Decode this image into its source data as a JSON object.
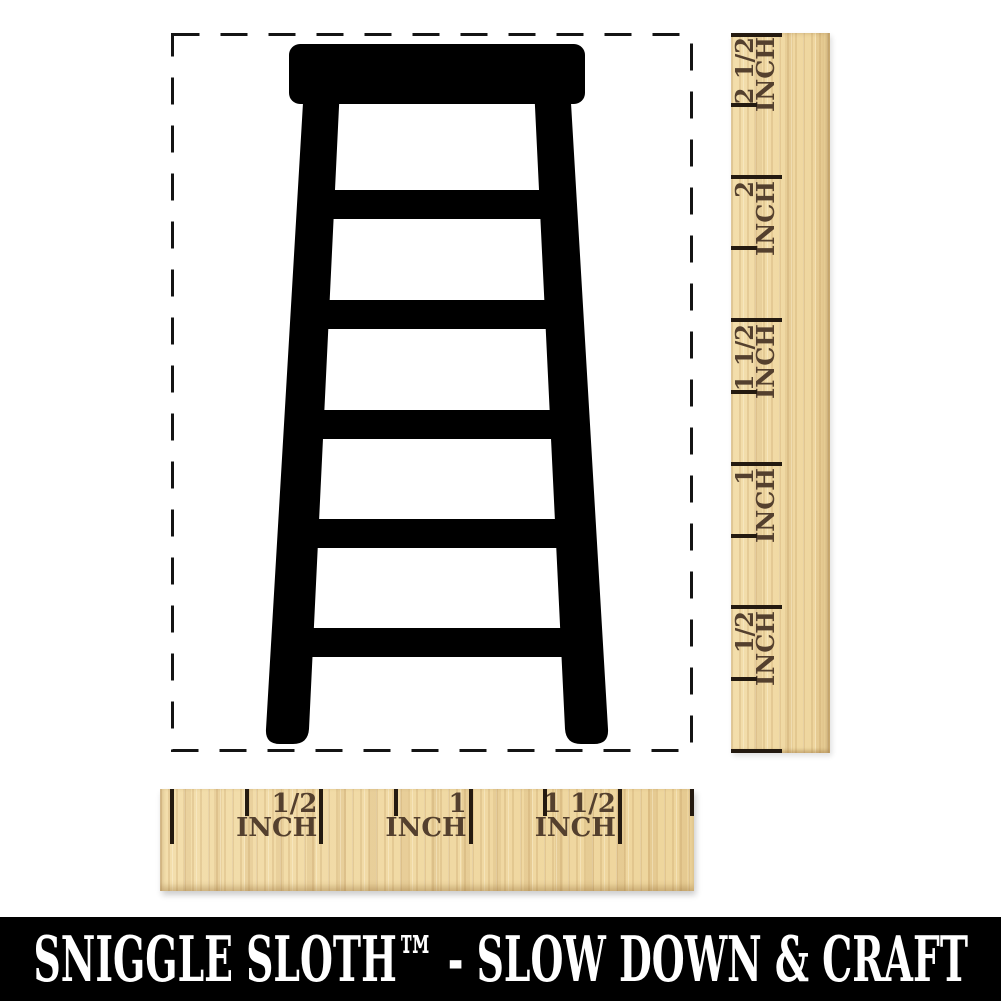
{
  "stamp": {
    "design_name": "step-stool-ladder",
    "ink_color": "#000000",
    "outline_style": "dashed"
  },
  "vertical_ruler": {
    "unit_label": "INCH",
    "major_labels": [
      "2 1/2",
      "2",
      "1 1/2",
      "1",
      "1/2"
    ],
    "major_inches": [
      2.5,
      2.0,
      1.5,
      1.0,
      0.5
    ],
    "minor_inches": [
      2.25,
      1.75,
      1.25,
      0.75,
      0.25
    ],
    "zero_inch": 0
  },
  "horizontal_ruler": {
    "unit_label": "INCH",
    "major_labels": [
      "1/2",
      "1",
      "1 1/2"
    ],
    "major_inches": [
      0.5,
      1.0,
      1.5
    ],
    "minor_inches": [
      0.25,
      0.75,
      1.25,
      1.75
    ],
    "zero_inch": 0
  },
  "footer": {
    "tagline": "SNIGGLE SLOTH™ - SLOW DOWN & CRAFT"
  },
  "colors": {
    "background": "#ffffff",
    "stamp_ink": "#000000",
    "wood": "#f1d9a3",
    "ruler_text": "#54402e",
    "ruler_tick": "#241a10",
    "footer_band": "#000000",
    "footer_text": "#ffffff"
  }
}
